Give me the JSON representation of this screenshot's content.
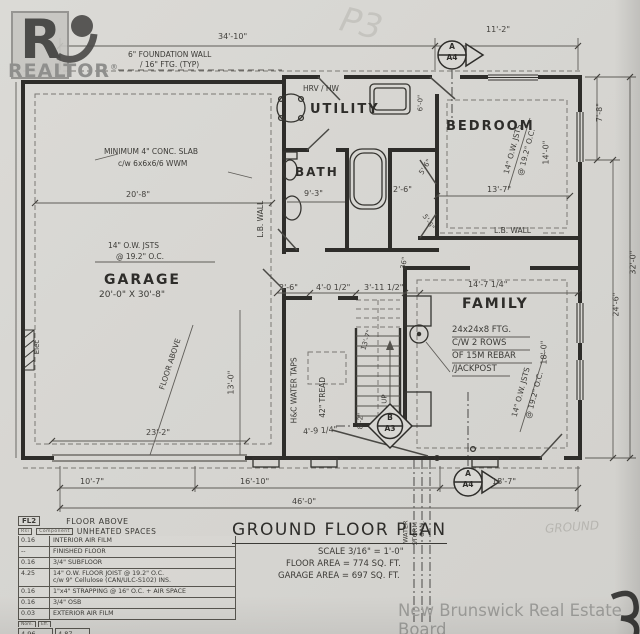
{
  "watermarks": {
    "logo_letter": "R",
    "realtor_text": "REALTOR",
    "registered": "®",
    "board_text": "New Brunswick Real Estate Board",
    "stamp": "P3",
    "ghost_text": "GROUND",
    "corner_mark": "3"
  },
  "title_block": {
    "title": "GROUND FLOOR PLAN",
    "scale": "SCALE 3/16\" = 1'-0\"",
    "floor_area": "FLOOR AREA = 774 SQ. FT.",
    "garage_area": "GARAGE AREA = 697 SQ. FT."
  },
  "rooms": {
    "garage_name": "GARAGE",
    "garage_size": "20'-0\" X 30'-8\"",
    "utility": "UTILITY",
    "bath": "BATH",
    "bedroom": "BEDROOM",
    "family": "FAMILY"
  },
  "notes": {
    "foundation_1": "6\" FOUNDATION WALL",
    "foundation_2": "/ 16\" FTG. (TYP)",
    "slab_1": "MINIMUM 4\" CONC. SLAB",
    "slab_2": "c/w 6x6x6/6 WWM",
    "joists_1": "14\" O.W. JSTS",
    "joists_2": "@ 19.2\" O.C.",
    "hrv": "HRV / HW",
    "lb_wall": "L.B. WALL",
    "elec": "Elec",
    "floor_above": "FLOOR ABOVE",
    "hc_taps": "H&C WATER TAPS",
    "tread": "42\" TREAD",
    "up": "UP",
    "footing_1": "24x24x8 FTG.",
    "footing_2": "C/W 2 ROWS",
    "footing_3": "OF 15M REBAR",
    "footing_4": "/JACKPOST",
    "water": "WATER",
    "storm": "STORM",
    "san": "SAN."
  },
  "dims": {
    "top_left": "34'-10\"",
    "top_right": "11'-2\"",
    "right_upper": "7'-8\"",
    "right_mid": "24'-6\"",
    "right_overall": "32'-0\"",
    "garage_width": "20'-8\"",
    "garage_door": "23'-2\"",
    "bath_width": "9'-3\"",
    "bedroom_width": "13'-7\"",
    "bedroom_depth": "14'-0\"",
    "hall_a": "2'-6\"",
    "hall_b": "4'-0 1/2\"",
    "hall_c": "3'-11 1/2\"",
    "closet_depth": "2'-6\"",
    "closet_door_a": "5'-6\"",
    "closet_door_b": "5'-6\"",
    "hall_height": "6'-0\"",
    "stair_run": "13'-7\"",
    "stair_width": "36\"",
    "floor_above_depth": "13'-0\"",
    "family_width": "14'-7 1/4\"",
    "family_depth": "18'-0\"",
    "door_diag": "4'-9 1/4\"",
    "stub": "8'-2\"",
    "bottom_a": "10'-7\"",
    "bottom_b": "16'-10\"",
    "bottom_c": "18'-7\"",
    "bottom_overall": "46'-0\""
  },
  "markers": {
    "a_top": {
      "letter": "A",
      "sheet": "A4"
    },
    "a_bottom": {
      "letter": "A",
      "sheet": "A4"
    },
    "b_mid": {
      "letter": "B",
      "sheet": "A3"
    }
  },
  "legend": {
    "tag": "FL2",
    "title": "FLOOR ABOVE",
    "subtitle": "UNHEATED SPACES",
    "col_rsi": "Rsi",
    "col_component": "Component",
    "rows": [
      {
        "rsi": "0.16",
        "desc": "INTERIOR AIR FILM"
      },
      {
        "rsi": "--",
        "desc": "FINISHED FLOOR"
      },
      {
        "rsi": "0.16",
        "desc": "3/4\" SUBFLOOR"
      },
      {
        "rsi": "4.25",
        "desc": "14\" O.W. FLOOR JOIST @ 19.2\" O.C.",
        "desc2": "c/w 9\" Cellulose (CAN/ULC-S102) INS."
      },
      {
        "rsi": "0.16",
        "desc": "1\"x4\" STRAPPING @ 16\" O.C. + AIR SPACE"
      },
      {
        "rsi": "0.16",
        "desc": "3/4\" OSB"
      },
      {
        "rsi": "0.03",
        "desc": "EXTERIOR AIR FILM"
      }
    ],
    "total_nom_label": "Nom.",
    "total_eff_label": "Eff.",
    "total_nom": "4.96",
    "total_eff": "4.87"
  }
}
